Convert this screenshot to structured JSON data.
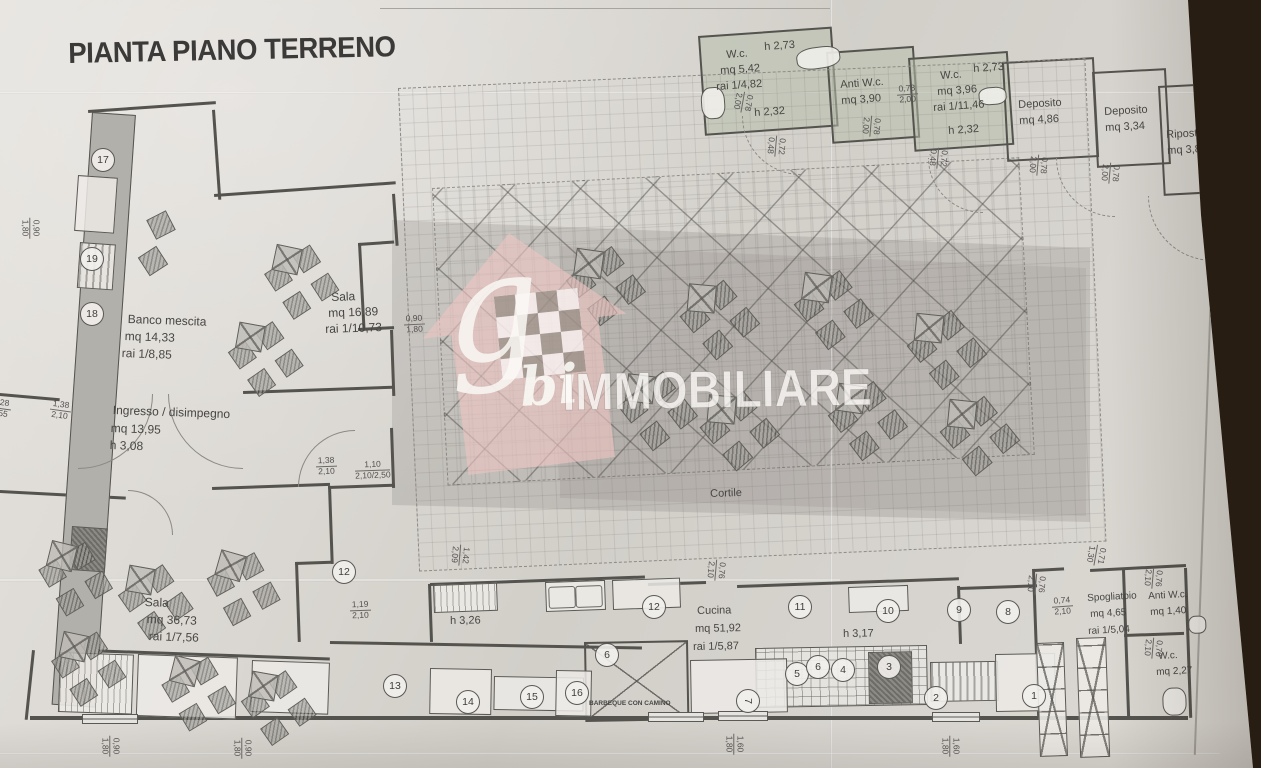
{
  "title": "PIANTA PIANO TERRENO",
  "watermark": {
    "g": "g",
    "bi": "bi",
    "name": "IMMOBILIARE"
  },
  "colors": {
    "paper": "#d9d6d1",
    "ink": "#474643",
    "wall": "#55534e",
    "room_green": "#b7beac",
    "background": "#281d12",
    "logo_pink": "#eec5c1"
  },
  "rooms_summary": [
    {
      "name": "W.c.",
      "height": "h 2,73",
      "area": "mq 5,42",
      "ratio": "rai 1/4,82"
    },
    {
      "name": "Anti W.c.",
      "area": "mq 3,90"
    },
    {
      "name": "W.c.",
      "height": "h 2,73",
      "area": "mq 3,96",
      "ratio": "rai 1/11,46"
    },
    {
      "name": "Deposito",
      "area": "mq 4,86"
    },
    {
      "name": "Deposito",
      "area": "mq 3,34"
    },
    {
      "name": "Ripostiglio",
      "area": "mq 3,86"
    },
    {
      "name": "Banco mescita",
      "area": "mq 14,33",
      "ratio": "rai 1/8,85"
    },
    {
      "name": "Sala",
      "area": "mq 16,89",
      "ratio": "rai 1/10,73"
    },
    {
      "name": "Ingresso / disimpegno",
      "area": "mq 13,95",
      "height": "h 3,08"
    },
    {
      "name": "Sala",
      "area": "mq 36,73",
      "ratio": "rai 1/7,56"
    },
    {
      "name": "Cortile"
    },
    {
      "name": "Cucina",
      "area": "mq 51,92",
      "ratio": "rai 1/5,87"
    },
    {
      "name": "Spogliatoio",
      "area": "mq 4,65",
      "ratio": "rai 1/5,04"
    },
    {
      "name": "Anti W.c.",
      "area": "mq 1,40"
    },
    {
      "name": "W.c.",
      "area": "mq 2,27"
    },
    {
      "name": "BARBEQUE CON CAMINO"
    }
  ],
  "plan": {
    "labels": [
      [
        "W.c.",
        726,
        50,
        11,
        -4,
        0
      ],
      [
        "h 2,73",
        764,
        42,
        11,
        -4,
        0
      ],
      [
        "mq 5,42",
        720,
        66,
        11,
        -4,
        0
      ],
      [
        "rai 1/4,82",
        716,
        82,
        11,
        -4,
        0
      ],
      [
        "h 2,32",
        754,
        108,
        11,
        -4,
        0
      ],
      [
        "Anti W.c.",
        840,
        80,
        11,
        -4,
        0
      ],
      [
        "mq 3,90",
        841,
        96,
        11,
        -4,
        0
      ],
      [
        "W.c.",
        940,
        71,
        11,
        -4,
        0
      ],
      [
        "h 2,73",
        973,
        64,
        11,
        -4,
        0
      ],
      [
        "mq 3,96",
        937,
        87,
        11,
        -4,
        0
      ],
      [
        "rai 1/11,46",
        933,
        103,
        11,
        -4,
        0
      ],
      [
        "h 2,32",
        948,
        126,
        11,
        -4,
        0
      ],
      [
        "Deposito",
        1018,
        100,
        11,
        -3,
        0
      ],
      [
        "mq 4,86",
        1019,
        116,
        11,
        -3,
        0
      ],
      [
        "Deposito",
        1104,
        107,
        11,
        -3,
        0
      ],
      [
        "mq 3,34",
        1105,
        123,
        11,
        -3,
        0
      ],
      [
        "Ripostiglio",
        1166,
        130,
        11,
        -3,
        0
      ],
      [
        "mq 3,86",
        1167,
        146,
        11,
        -3,
        0
      ],
      [
        "Banco mescita",
        128,
        313,
        12,
        2,
        0
      ],
      [
        "mq 14,33",
        125,
        330,
        12,
        2,
        0
      ],
      [
        "rai 1/8,85",
        122,
        347,
        12,
        2,
        0
      ],
      [
        "Sala",
        331,
        291,
        12,
        -2,
        0
      ],
      [
        "mq 16,89",
        328,
        307,
        12,
        -2,
        0
      ],
      [
        "rai 1/10,73",
        325,
        323,
        12,
        -2,
        0
      ],
      [
        "Ingresso / disimpegno",
        113,
        404,
        12,
        2,
        0
      ],
      [
        "mq 13,95",
        111,
        422,
        12,
        2,
        0
      ],
      [
        "h 3,08",
        110,
        439,
        12,
        2,
        0
      ],
      [
        "Sala",
        145,
        596,
        12,
        2,
        0
      ],
      [
        "mq 36,73",
        147,
        613,
        12,
        2,
        0
      ],
      [
        "rai 1/7,56",
        149,
        630,
        12,
        2,
        0
      ],
      [
        "Cortile",
        710,
        489,
        11,
        -2,
        0
      ],
      [
        "h 3,26",
        450,
        616,
        11,
        -1,
        0
      ],
      [
        "Cucina",
        697,
        606,
        11,
        -1,
        0
      ],
      [
        "mq 51,92",
        695,
        624,
        11,
        -1,
        0
      ],
      [
        "rai 1/5,87",
        693,
        642,
        11,
        -1,
        0
      ],
      [
        "h 3,17",
        843,
        629,
        11,
        -1,
        0
      ],
      [
        "Spogliatoio",
        1087,
        594,
        10,
        -3,
        0
      ],
      [
        "mq 4,65",
        1090,
        610,
        10,
        -3,
        0
      ],
      [
        "rai 1/5,04",
        1088,
        627,
        10,
        -3,
        0
      ],
      [
        "Anti W.c.",
        1148,
        592,
        10,
        -3,
        0
      ],
      [
        "mq 1,40",
        1150,
        608,
        10,
        -3,
        0
      ],
      [
        "W.c.",
        1158,
        652,
        10,
        -3,
        0
      ],
      [
        "mq 2,27",
        1156,
        668,
        10,
        -3,
        0
      ],
      [
        "BARBEQUE CON CAMINO",
        589,
        701,
        6.5,
        0,
        1
      ]
    ],
    "dims": [
      [
        "0,90",
        "1,80",
        20,
        218,
        90
      ],
      [
        "1,28",
        "2,55",
        -10,
        398,
        8
      ],
      [
        "1,38",
        "2,10",
        50,
        400,
        8
      ],
      [
        "0,90",
        "1,80",
        404,
        314,
        -3
      ],
      [
        "1,38",
        "2,10",
        316,
        456,
        -2
      ],
      [
        "1,10",
        "2,10/2,50",
        355,
        460,
        -2
      ],
      [
        "1,19",
        "2,10",
        350,
        600,
        -2
      ],
      [
        "1,42",
        "2,09",
        450,
        545,
        95
      ],
      [
        "0,76",
        "2,10",
        706,
        560,
        95
      ],
      [
        "0,78",
        "2,00",
        733,
        92,
        100
      ],
      [
        "0,72",
        "0,48",
        766,
        136,
        95
      ],
      [
        "0,78",
        "2,00",
        897,
        84,
        -4
      ],
      [
        "0,78",
        "2,00",
        861,
        116,
        95
      ],
      [
        "0,72",
        "0,48",
        928,
        148,
        95
      ],
      [
        "0,78",
        "2,00",
        1028,
        155,
        95
      ],
      [
        "0,78",
        "2,00",
        1100,
        163,
        95
      ],
      [
        "0,76",
        "2,10",
        1026,
        574,
        95
      ],
      [
        "0,71",
        "1,30",
        1086,
        545,
        100
      ],
      [
        "0,74",
        "2,10",
        1052,
        596,
        -4
      ],
      [
        "0,76",
        "2,10",
        1143,
        568,
        95
      ],
      [
        "0,70",
        "2,10",
        1143,
        638,
        95
      ],
      [
        "0,90",
        "1,80",
        100,
        736,
        90
      ],
      [
        "0,90",
        "1,80",
        232,
        738,
        90
      ],
      [
        "1,60",
        "1,80",
        724,
        734,
        90
      ],
      [
        "1,60",
        "1,80",
        940,
        736,
        90
      ]
    ],
    "circles": [
      [
        "17",
        91,
        148,
        0
      ],
      [
        "19",
        80,
        247,
        0
      ],
      [
        "18",
        80,
        302,
        0
      ],
      [
        "12",
        332,
        560,
        0
      ],
      [
        "13",
        383,
        674,
        0
      ],
      [
        "14",
        456,
        690,
        0
      ],
      [
        "15",
        520,
        685,
        0
      ],
      [
        "16",
        565,
        681,
        0
      ],
      [
        "12",
        642,
        595,
        0
      ],
      [
        "11",
        788,
        595,
        0
      ],
      [
        "10",
        876,
        599,
        0
      ],
      [
        "9",
        947,
        598,
        0
      ],
      [
        "8",
        996,
        600,
        0
      ],
      [
        "6",
        595,
        643,
        0
      ],
      [
        "5",
        785,
        662,
        0
      ],
      [
        "6",
        806,
        655,
        0
      ],
      [
        "4",
        831,
        658,
        0
      ],
      [
        "3",
        877,
        655,
        0
      ],
      [
        "7",
        736,
        689,
        90
      ],
      [
        "2",
        924,
        686,
        0
      ],
      [
        "1",
        1022,
        684,
        0
      ]
    ],
    "rooms": [
      [
        698,
        36,
        130,
        96,
        -4,
        "g"
      ],
      [
        826,
        52,
        84,
        88,
        -4,
        "g"
      ],
      [
        908,
        58,
        96,
        90,
        -4,
        "g"
      ],
      [
        1002,
        62,
        88,
        96,
        -3,
        ""
      ],
      [
        1092,
        72,
        70,
        92,
        -3,
        ""
      ],
      [
        1158,
        86,
        86,
        106,
        -3,
        ""
      ],
      [
        398,
        88,
        686,
        482,
        -2.5,
        "dash"
      ],
      [
        432,
        188,
        586,
        296,
        -3,
        "perg"
      ],
      [
        584,
        642,
        100,
        76,
        -1,
        "diag"
      ],
      [
        755,
        648,
        170,
        58,
        -1,
        "grid-eq"
      ]
    ],
    "walls": [
      [
        88,
        110,
        128,
        3,
        -4
      ],
      [
        212,
        110,
        3,
        90,
        -4
      ],
      [
        214,
        194,
        182,
        3,
        -4
      ],
      [
        392,
        194,
        3,
        52,
        -4
      ],
      [
        358,
        243,
        36,
        3,
        -4
      ],
      [
        358,
        243,
        3,
        88,
        -3
      ],
      [
        358,
        328,
        36,
        3,
        -3
      ],
      [
        390,
        330,
        3,
        66,
        -2
      ],
      [
        390,
        428,
        3,
        60,
        -2
      ],
      [
        328,
        486,
        66,
        3,
        -2
      ],
      [
        328,
        486,
        3,
        78,
        -2
      ],
      [
        295,
        562,
        36,
        3,
        -2
      ],
      [
        295,
        562,
        3,
        80,
        -2
      ],
      [
        0,
        393,
        60,
        3,
        5
      ],
      [
        243,
        391,
        150,
        3,
        -2
      ],
      [
        0,
        490,
        126,
        3,
        3
      ],
      [
        212,
        487,
        118,
        3,
        -2
      ],
      [
        32,
        650,
        3,
        70,
        6
      ],
      [
        30,
        716,
        1158,
        4,
        0
      ],
      [
        58,
        648,
        272,
        3,
        2
      ],
      [
        330,
        641,
        312,
        3,
        1
      ],
      [
        428,
        584,
        3,
        58,
        -2
      ],
      [
        430,
        583,
        215,
        3,
        -2
      ],
      [
        648,
        583,
        58,
        3,
        -2
      ],
      [
        737,
        585,
        222,
        3,
        -2
      ],
      [
        957,
        586,
        3,
        58,
        -2
      ],
      [
        959,
        587,
        78,
        3,
        -2
      ],
      [
        1034,
        569,
        30,
        3,
        -3
      ],
      [
        1090,
        569,
        96,
        3,
        -3
      ],
      [
        1032,
        569,
        3,
        148,
        -2
      ],
      [
        1122,
        570,
        3,
        148,
        -2
      ],
      [
        1124,
        634,
        60,
        3,
        -2
      ],
      [
        1184,
        568,
        3,
        150,
        -2
      ]
    ],
    "tables": [
      [
        572,
        252,
        8,
        1,
        "c"
      ],
      [
        686,
        286,
        5,
        1,
        "c"
      ],
      [
        800,
        276,
        8,
        1,
        "c"
      ],
      [
        913,
        316,
        6,
        1,
        "c"
      ],
      [
        624,
        377,
        7,
        1,
        "c"
      ],
      [
        706,
        397,
        5,
        1,
        "c"
      ],
      [
        834,
        387,
        8,
        1,
        "c"
      ],
      [
        946,
        402,
        6,
        1,
        "c"
      ],
      [
        268,
        248,
        12,
        0.95,
        "c"
      ],
      [
        232,
        325,
        10,
        0.95,
        "c"
      ],
      [
        150,
        214,
        18,
        1,
        "s"
      ],
      [
        142,
        250,
        12,
        1,
        "s"
      ],
      [
        42,
        545,
        14,
        0.95,
        "c"
      ],
      [
        122,
        568,
        10,
        0.95,
        "c"
      ],
      [
        210,
        555,
        16,
        0.95,
        "c"
      ],
      [
        55,
        635,
        12,
        0.95,
        "c"
      ],
      [
        165,
        660,
        14,
        0.95,
        "c"
      ],
      [
        245,
        674,
        10,
        0.95,
        "c"
      ]
    ],
    "equip": [
      [
        433,
        585,
        62,
        26,
        "lines",
        -2
      ],
      [
        545,
        582,
        58,
        28,
        "sink",
        -2
      ],
      [
        612,
        580,
        66,
        28,
        "plain",
        -2
      ],
      [
        848,
        587,
        58,
        24,
        "plain",
        -2
      ],
      [
        690,
        660,
        95,
        52,
        "plain",
        -1
      ],
      [
        868,
        652,
        42,
        50,
        "dark",
        -1
      ],
      [
        930,
        662,
        66,
        38,
        "dots",
        -1
      ],
      [
        995,
        654,
        58,
        56,
        "plain",
        -1
      ],
      [
        60,
        652,
        72,
        58,
        "lines",
        2
      ],
      [
        138,
        654,
        98,
        60,
        "plain",
        2
      ],
      [
        252,
        660,
        76,
        50,
        "plain",
        2
      ],
      [
        430,
        668,
        60,
        44,
        "plain",
        1
      ],
      [
        494,
        676,
        88,
        32,
        "plain",
        1
      ],
      [
        556,
        670,
        34,
        44,
        "plain",
        1
      ],
      [
        1036,
        643,
        26,
        112,
        "xhatch",
        -2
      ],
      [
        1076,
        638,
        28,
        118,
        "xhatch",
        -2
      ],
      [
        700,
        88,
        22,
        30,
        "fix",
        -4
      ],
      [
        795,
        50,
        42,
        20,
        "fix",
        -8
      ],
      [
        978,
        88,
        26,
        16,
        "fix",
        -4
      ],
      [
        1162,
        688,
        22,
        26,
        "fix",
        -2
      ],
      [
        1188,
        616,
        16,
        16,
        "fix",
        -2
      ],
      [
        78,
        175,
        38,
        54,
        "plain",
        4
      ],
      [
        80,
        242,
        34,
        44,
        "dots",
        4
      ],
      [
        72,
        526,
        34,
        42,
        "dark",
        4
      ]
    ],
    "arcs": [
      [
        78,
        394,
        74,
        90,
        0
      ],
      [
        168,
        394,
        74,
        180,
        0
      ],
      [
        298,
        430,
        56,
        270,
        0
      ],
      [
        128,
        490,
        44,
        0,
        0
      ],
      [
        742,
        116,
        58,
        180,
        1
      ],
      [
        928,
        158,
        54,
        180,
        1
      ],
      [
        1056,
        158,
        58,
        180,
        1
      ],
      [
        1148,
        196,
        64,
        180,
        1
      ]
    ],
    "windows": [
      [
        82,
        714,
        54,
        8
      ],
      [
        648,
        712,
        54,
        8
      ],
      [
        718,
        711,
        48,
        8
      ],
      [
        932,
        712,
        46,
        8
      ]
    ],
    "sheetlines": [
      [
        380,
        8,
        450,
        1,
        0
      ],
      [
        1206,
        55,
        1.5,
        700,
        2
      ]
    ],
    "creases": [
      [
        830,
        0,
        3,
        768,
        "v"
      ],
      [
        0,
        91,
        1261,
        3,
        "h"
      ],
      [
        0,
        578,
        840,
        4,
        "h"
      ],
      [
        0,
        752,
        1220,
        3,
        "h"
      ]
    ]
  }
}
